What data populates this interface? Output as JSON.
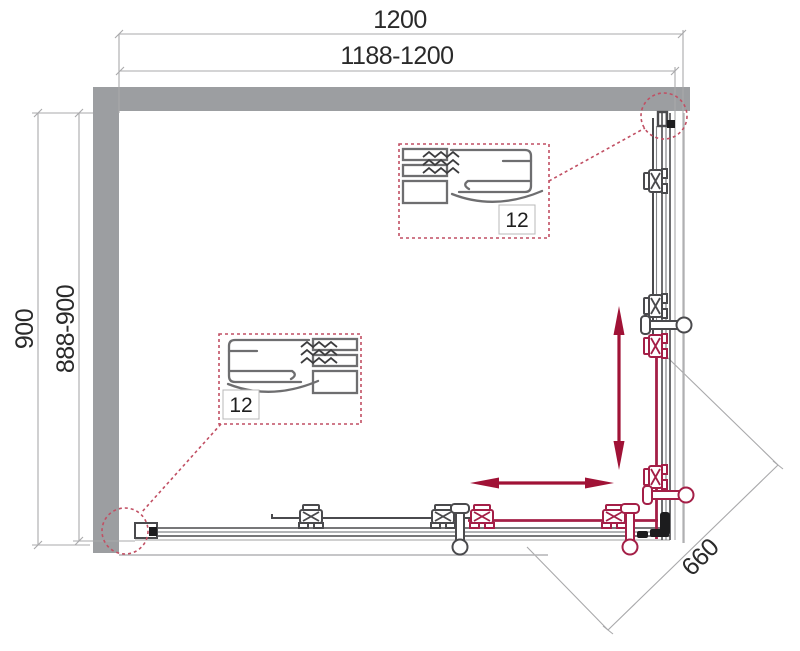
{
  "title": "Corner shower enclosure plan drawing",
  "dimensions": {
    "top_outer": "1200",
    "top_inner": "1188-1200",
    "left_outer": "900",
    "left_inner": "888-900",
    "corner_diagonal": "660"
  },
  "details": [
    {
      "label": "12"
    },
    {
      "label": "12"
    }
  ],
  "colors": {
    "wall_gray": "#9c9ea1",
    "line_dark": "#4a4a4d",
    "line_light": "#b3b3b5",
    "dim_gray": "#a9a9ab",
    "text_dark": "#2a2a2a",
    "arrow_red": "#a01236",
    "hardware_red": "#a41f47",
    "callout_red": "#c14f63"
  }
}
